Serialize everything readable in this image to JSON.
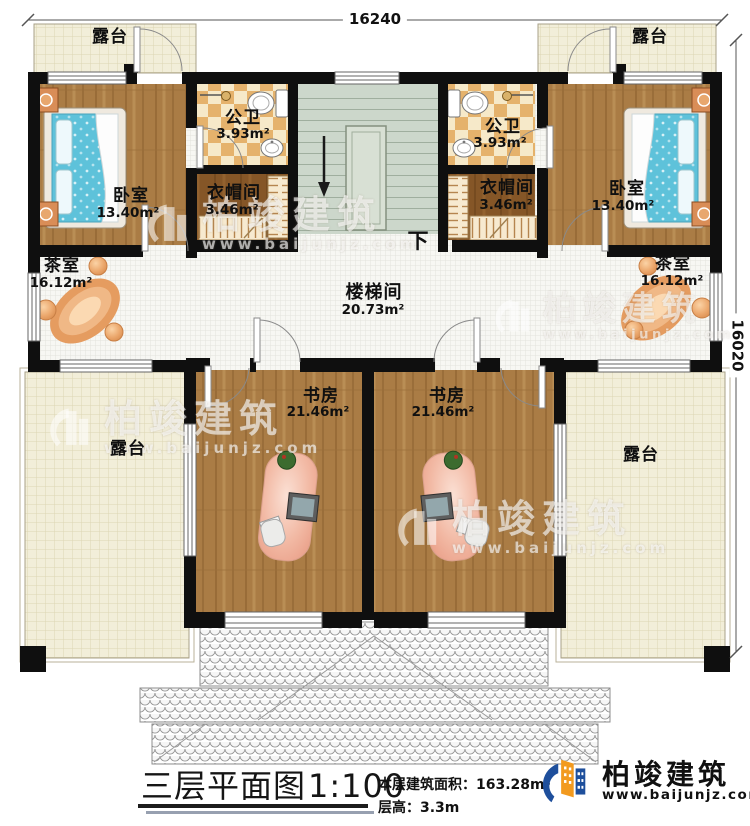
{
  "dimensions": {
    "top": "16240",
    "right": "16020"
  },
  "rooms": {
    "terrace_tl": {
      "name": "露台"
    },
    "terrace_tr": {
      "name": "露台"
    },
    "terrace_bl": {
      "name": "露台"
    },
    "terrace_br": {
      "name": "露台"
    },
    "bedroom_l": {
      "name": "卧室",
      "area": "13.40m²"
    },
    "bedroom_r": {
      "name": "卧室",
      "area": "13.40m²"
    },
    "bath_l": {
      "name": "公卫",
      "area": "3.93m²"
    },
    "bath_r": {
      "name": "公卫",
      "area": "3.93m²"
    },
    "cloak_l": {
      "name": "衣帽间",
      "area": "3.46m²"
    },
    "cloak_r": {
      "name": "衣帽间",
      "area": "3.46m²"
    },
    "tea_l": {
      "name": "茶室",
      "area": "16.12m²"
    },
    "tea_r": {
      "name": "茶室",
      "area": "16.12m²"
    },
    "stair_hall": {
      "name": "楼梯间",
      "area": "20.73m²"
    },
    "study_l": {
      "name": "书房",
      "area": "21.46m²"
    },
    "study_r": {
      "name": "书房",
      "area": "21.46m²"
    }
  },
  "stairs": {
    "down_label": "下"
  },
  "title_block": {
    "title": "三层平面图",
    "scale": "1:100",
    "area_label": "本层建筑面积：163.28m²",
    "floor_height_label": "层高：3.3m"
  },
  "brand": {
    "name": "柏竣建筑",
    "url": "www.baijunjz.com"
  },
  "watermark": {
    "name": "柏竣建筑",
    "url": "www.baijunjz.com"
  },
  "colors": {
    "wall": "#0f0f0f",
    "wood": "#aa7c45",
    "wood_dark": "#855627",
    "bath_check_a": "#f6e9c9",
    "bath_check_b": "#e5b26c",
    "stairs": "#ccd7cb",
    "terrace": "#f2eed9",
    "hall_tile": "#f7f7f3",
    "mattress": "#5ec2da",
    "accent_blue": "#1e4f9c",
    "accent_orange": "#f29a1f"
  }
}
